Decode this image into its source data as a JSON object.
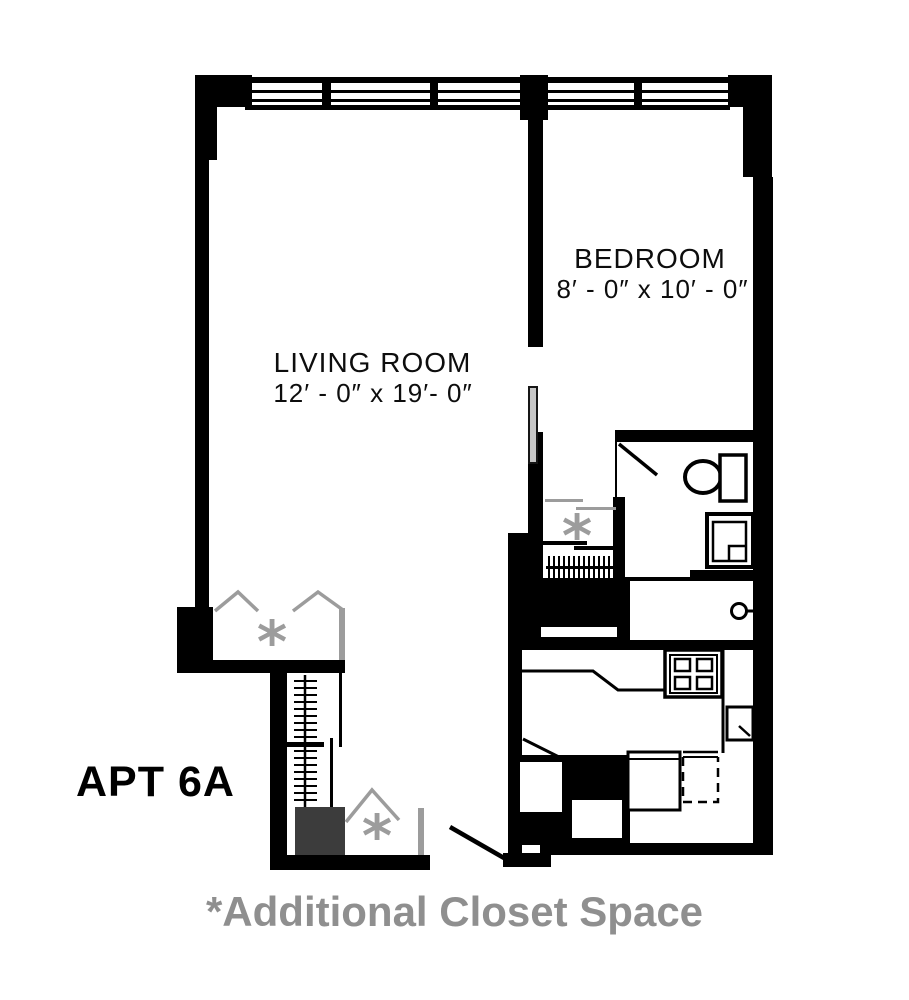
{
  "plan": {
    "apt_label": "APT 6A",
    "footnote": "*Additional Closet Space",
    "closet_marker": "*",
    "rooms": {
      "bedroom": {
        "name": "BEDROOM",
        "dims": "8′ - 0″ x 10′ - 0″"
      },
      "living_room": {
        "name": "LIVING ROOM",
        "dims": "12′ - 0″ x 19′- 0″"
      }
    },
    "fixtures": [
      "window",
      "toilet",
      "vanity-sink",
      "stove",
      "kitchen-sink",
      "refrigerator",
      "dishwasher",
      "closet-rod",
      "bifold-door",
      "door-swing",
      "door-leaf",
      "door-knob"
    ],
    "colors": {
      "wall": "#000000",
      "annotation": "#9c9c9c",
      "footnote_gray": "#8f8f8f",
      "dark_shelf": "#3c3c3c",
      "door_leaf": "#c6c6c6"
    }
  }
}
